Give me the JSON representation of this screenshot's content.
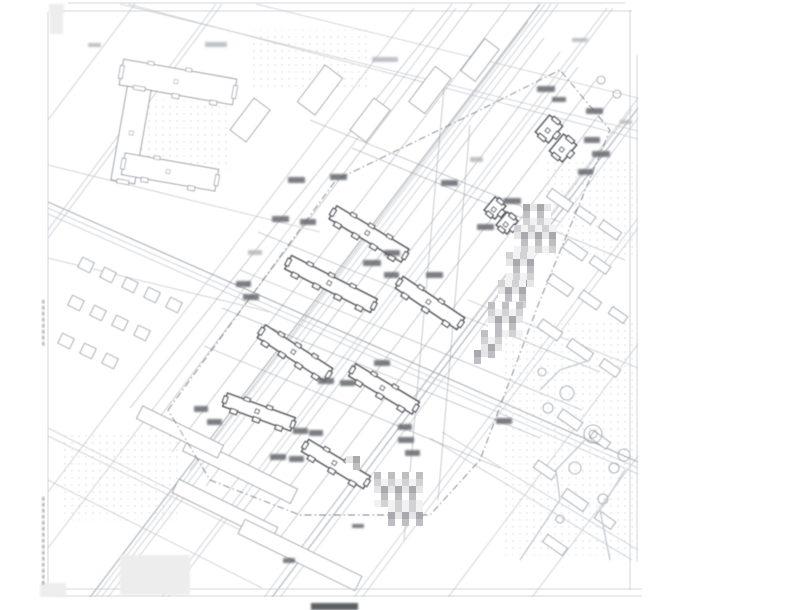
{
  "drawing": {
    "kind": "scanned architectural site plan (blurred, text illegible)",
    "canvas": {
      "w": 800,
      "h": 610,
      "bg": "#ffffff"
    },
    "clip": {
      "x": 46,
      "y": 3,
      "w": 596,
      "h": 594
    },
    "palette": {
      "frame": "#c7cacf",
      "line_light": "#c6cad0",
      "line_med": "#aab0b8",
      "line_dark": "#8d939b",
      "boundary": "#7d828a",
      "building_stroke": "#54585f",
      "building_fill": "#ffffff",
      "light_building_stroke": "#9aa0a8",
      "chip_dark": "#63666c",
      "chip_light": "#b7bbc1",
      "dot": "#aeb3bb",
      "mosaic_cells": [
        "#ffffff",
        "#e6e6e8",
        "#d2d2d5",
        "#bfbfc3",
        "#a8a8ad",
        "#f2f2f3"
      ]
    },
    "frame_lines": [
      [
        68,
        3,
        625,
        3,
        "light"
      ],
      [
        50,
        11,
        632,
        11,
        "light"
      ],
      [
        48,
        12,
        48,
        589,
        "light"
      ],
      [
        630,
        10,
        630,
        590,
        "light"
      ],
      [
        637,
        55,
        637,
        562,
        "light"
      ],
      [
        55,
        589,
        642,
        589,
        "light"
      ],
      [
        55,
        596,
        642,
        596,
        "light"
      ]
    ],
    "margin": {
      "title_chip": {
        "x": 311,
        "y": 603,
        "w": 47,
        "h": 7
      },
      "corner_chips": [
        {
          "x": 49,
          "y": 4,
          "w": 15,
          "h": 9
        },
        {
          "x": 50,
          "y": 10,
          "w": 13,
          "h": 24
        },
        {
          "x": 40,
          "y": 583,
          "w": 26,
          "h": 14
        },
        {
          "x": 120,
          "y": 555,
          "w": 70,
          "h": 40
        }
      ],
      "left_text_strips": [
        {
          "x": 42,
          "y": 300,
          "h": 44
        },
        {
          "x": 42,
          "y": 497,
          "h": 86
        }
      ]
    },
    "roads_b": [
      [
        88,
        600,
        540,
        4,
        "med"
      ],
      [
        93,
        600,
        545,
        4,
        "light"
      ],
      [
        99,
        600,
        551,
        4,
        "light"
      ],
      [
        106,
        600,
        558,
        4,
        "light"
      ],
      [
        48,
        548,
        456,
        8,
        "light"
      ],
      [
        48,
        492,
        414,
        8,
        "light"
      ],
      [
        160,
        600,
        607,
        8,
        "light"
      ],
      [
        166,
        600,
        613,
        8,
        "light"
      ],
      [
        262,
        600,
        638,
        98,
        "light"
      ],
      [
        270,
        600,
        638,
        108,
        "med"
      ],
      [
        278,
        600,
        638,
        118,
        "light"
      ],
      [
        352,
        600,
        638,
        218,
        "light"
      ],
      [
        360,
        600,
        638,
        228,
        "light"
      ],
      [
        446,
        600,
        638,
        344,
        "light"
      ],
      [
        48,
        238,
        222,
        4,
        "light"
      ],
      [
        48,
        230,
        216,
        4,
        "light"
      ],
      [
        48,
        120,
        135,
        4,
        "light"
      ],
      [
        530,
        600,
        638,
        456,
        "light"
      ]
    ],
    "roads_a": [
      [
        48,
        202,
        638,
        462,
        "med"
      ],
      [
        48,
        208,
        638,
        468,
        "light"
      ],
      [
        48,
        214,
        638,
        474,
        "light"
      ],
      [
        48,
        258,
        270,
        312,
        "light"
      ],
      [
        48,
        165,
        320,
        232,
        "light"
      ],
      [
        120,
        4,
        638,
        131,
        "light"
      ],
      [
        128,
        4,
        638,
        139,
        "light"
      ],
      [
        256,
        4,
        638,
        98,
        "light"
      ],
      [
        48,
        428,
        310,
        560,
        "light"
      ],
      [
        48,
        436,
        318,
        568,
        "light"
      ],
      [
        48,
        480,
        262,
        588,
        "light"
      ],
      [
        430,
        438,
        632,
        560,
        "light"
      ],
      [
        442,
        432,
        638,
        550,
        "light"
      ],
      [
        468,
        300,
        638,
        368,
        "light"
      ]
    ],
    "thin_lines": [
      [
        130,
        408,
        452,
        4
      ],
      [
        150,
        430,
        472,
        4
      ],
      [
        172,
        452,
        510,
        4
      ],
      [
        190,
        470,
        528,
        22
      ],
      [
        206,
        486,
        544,
        38
      ],
      [
        222,
        500,
        560,
        52
      ],
      [
        240,
        515,
        578,
        67
      ],
      [
        258,
        528,
        596,
        80
      ],
      [
        276,
        543,
        614,
        95
      ],
      [
        294,
        557,
        632,
        109
      ],
      [
        258,
        232,
        600,
        372
      ],
      [
        240,
        270,
        582,
        410
      ],
      [
        222,
        308,
        540,
        438
      ],
      [
        204,
        346,
        500,
        468
      ],
      [
        352,
        148,
        625,
        260
      ],
      [
        310,
        120,
        560,
        222
      ],
      [
        444,
        88,
        404,
        540
      ],
      [
        470,
        125,
        438,
        500
      ]
    ],
    "boundary": {
      "points": [
        [
          168,
          410
        ],
        [
          336,
          180
        ],
        [
          470,
          115
        ],
        [
          560,
          70
        ],
        [
          610,
          130
        ],
        [
          540,
          300
        ],
        [
          480,
          460
        ],
        [
          430,
          515
        ],
        [
          300,
          515
        ],
        [
          210,
          480
        ]
      ],
      "dash": "7 3 1.5 3"
    },
    "site_buildings": [
      {
        "cx": 369,
        "cy": 234,
        "len": 84,
        "wid": 15,
        "angle": 31,
        "teeth": 4
      },
      {
        "cx": 331,
        "cy": 284,
        "len": 96,
        "wid": 15,
        "angle": 27,
        "teeth": 4
      },
      {
        "cx": 430,
        "cy": 303,
        "len": 74,
        "wid": 14,
        "angle": 34,
        "teeth": 3
      },
      {
        "cx": 295,
        "cy": 353,
        "len": 80,
        "wid": 15,
        "angle": 33,
        "teeth": 4
      },
      {
        "cx": 384,
        "cy": 389,
        "len": 74,
        "wid": 14,
        "angle": 31,
        "teeth": 3
      },
      {
        "cx": 259,
        "cy": 412,
        "len": 72,
        "wid": 14,
        "angle": 20,
        "teeth": 3
      },
      {
        "cx": 336,
        "cy": 464,
        "len": 72,
        "wid": 14,
        "angle": 31,
        "teeth": 3
      },
      {
        "cx": 549,
        "cy": 129,
        "len": 22,
        "wid": 17,
        "angle": -50,
        "teeth": 1
      },
      {
        "cx": 563,
        "cy": 148,
        "len": 22,
        "wid": 17,
        "angle": -50,
        "teeth": 1
      },
      {
        "cx": 495,
        "cy": 208,
        "len": 17,
        "wid": 14,
        "angle": -50,
        "teeth": 1
      },
      {
        "cx": 507,
        "cy": 223,
        "len": 17,
        "wid": 14,
        "angle": -50,
        "teeth": 1
      }
    ],
    "u_block": [
      {
        "cx": 178,
        "cy": 82,
        "len": 115,
        "wid": 26,
        "angle": 10,
        "teeth": 3
      },
      {
        "cx": 131,
        "cy": 135,
        "len": 95,
        "wid": 24,
        "angle": 100,
        "teeth": 0
      },
      {
        "cx": 170,
        "cy": 172,
        "len": 95,
        "wid": 22,
        "angle": 10,
        "teeth": 2
      }
    ],
    "light_buildings": [
      {
        "cx": 560,
        "cy": 200,
        "w": 26,
        "h": 10,
        "angle": 35
      },
      {
        "cx": 585,
        "cy": 215,
        "w": 20,
        "h": 9,
        "angle": 35
      },
      {
        "cx": 610,
        "cy": 230,
        "w": 22,
        "h": 9,
        "angle": 35
      },
      {
        "cx": 575,
        "cy": 250,
        "w": 24,
        "h": 10,
        "angle": 35
      },
      {
        "cx": 600,
        "cy": 265,
        "w": 20,
        "h": 9,
        "angle": 35
      },
      {
        "cx": 560,
        "cy": 285,
        "w": 26,
        "h": 10,
        "angle": 35
      },
      {
        "cx": 590,
        "cy": 300,
        "w": 22,
        "h": 9,
        "angle": 35
      },
      {
        "cx": 618,
        "cy": 315,
        "w": 18,
        "h": 8,
        "angle": 35
      },
      {
        "cx": 550,
        "cy": 330,
        "w": 24,
        "h": 10,
        "angle": 35
      },
      {
        "cx": 580,
        "cy": 350,
        "w": 26,
        "h": 10,
        "angle": 35
      },
      {
        "cx": 610,
        "cy": 368,
        "w": 20,
        "h": 9,
        "angle": 35
      },
      {
        "cx": 570,
        "cy": 420,
        "w": 24,
        "h": 10,
        "angle": 35
      },
      {
        "cx": 600,
        "cy": 440,
        "w": 20,
        "h": 8,
        "angle": 35
      },
      {
        "cx": 545,
        "cy": 470,
        "w": 22,
        "h": 9,
        "angle": 35
      },
      {
        "cx": 575,
        "cy": 500,
        "w": 26,
        "h": 10,
        "angle": 35
      },
      {
        "cx": 605,
        "cy": 520,
        "w": 20,
        "h": 9,
        "angle": 35
      },
      {
        "cx": 555,
        "cy": 545,
        "w": 24,
        "h": 9,
        "angle": 35
      },
      {
        "cx": 320,
        "cy": 90,
        "w": 46,
        "h": 22,
        "angle": -53
      },
      {
        "cx": 370,
        "cy": 120,
        "w": 40,
        "h": 20,
        "angle": -53
      },
      {
        "cx": 430,
        "cy": 90,
        "w": 44,
        "h": 20,
        "angle": -53
      },
      {
        "cx": 480,
        "cy": 60,
        "w": 40,
        "h": 18,
        "angle": -53
      },
      {
        "cx": 250,
        "cy": 120,
        "w": 40,
        "h": 20,
        "angle": -53
      },
      {
        "cx": 240,
        "cy": 470,
        "w": 120,
        "h": 16,
        "angle": 26
      },
      {
        "cx": 225,
        "cy": 510,
        "w": 110,
        "h": 15,
        "angle": 26
      },
      {
        "cx": 300,
        "cy": 555,
        "w": 130,
        "h": 16,
        "angle": 26
      },
      {
        "cx": 180,
        "cy": 432,
        "w": 90,
        "h": 14,
        "angle": 26
      },
      {
        "cx": 86,
        "cy": 265,
        "w": 13,
        "h": 11,
        "angle": 26
      },
      {
        "cx": 108,
        "cy": 275,
        "w": 13,
        "h": 11,
        "angle": 26
      },
      {
        "cx": 130,
        "cy": 285,
        "w": 13,
        "h": 11,
        "angle": 26
      },
      {
        "cx": 152,
        "cy": 295,
        "w": 13,
        "h": 11,
        "angle": 26
      },
      {
        "cx": 174,
        "cy": 305,
        "w": 13,
        "h": 11,
        "angle": 26
      },
      {
        "cx": 76,
        "cy": 303,
        "w": 13,
        "h": 11,
        "angle": 26
      },
      {
        "cx": 98,
        "cy": 313,
        "w": 13,
        "h": 11,
        "angle": 26
      },
      {
        "cx": 120,
        "cy": 323,
        "w": 13,
        "h": 11,
        "angle": 26
      },
      {
        "cx": 142,
        "cy": 333,
        "w": 13,
        "h": 11,
        "angle": 26
      },
      {
        "cx": 66,
        "cy": 341,
        "w": 13,
        "h": 11,
        "angle": 26
      },
      {
        "cx": 88,
        "cy": 351,
        "w": 13,
        "h": 11,
        "angle": 26
      },
      {
        "cx": 110,
        "cy": 361,
        "w": 13,
        "h": 11,
        "angle": 26
      }
    ],
    "chips_dark": [
      [
        288,
        177,
        17,
        6
      ],
      [
        330,
        174,
        17,
        6
      ],
      [
        272,
        216,
        17,
        6
      ],
      [
        300,
        219,
        16,
        6
      ],
      [
        363,
        260,
        18,
        6
      ],
      [
        426,
        272,
        17,
        6
      ],
      [
        477,
        224,
        17,
        6
      ],
      [
        504,
        198,
        17,
        6
      ],
      [
        537,
        86,
        18,
        6
      ],
      [
        552,
        97,
        14,
        5
      ],
      [
        586,
        108,
        17,
        6
      ],
      [
        584,
        137,
        16,
        6
      ],
      [
        592,
        151,
        18,
        6
      ],
      [
        578,
        169,
        15,
        6
      ],
      [
        441,
        180,
        17,
        6
      ],
      [
        384,
        250,
        16,
        6
      ],
      [
        384,
        272,
        15,
        6
      ],
      [
        236,
        281,
        15,
        6
      ],
      [
        243,
        294,
        16,
        6
      ],
      [
        374,
        360,
        16,
        6
      ],
      [
        318,
        378,
        16,
        6
      ],
      [
        340,
        380,
        15,
        6
      ],
      [
        293,
        428,
        15,
        6
      ],
      [
        309,
        430,
        14,
        6
      ],
      [
        194,
        406,
        14,
        6
      ],
      [
        207,
        419,
        15,
        6
      ],
      [
        270,
        454,
        16,
        6
      ],
      [
        289,
        456,
        15,
        6
      ],
      [
        398,
        424,
        14,
        6
      ],
      [
        398,
        437,
        16,
        6
      ],
      [
        405,
        450,
        15,
        6
      ],
      [
        496,
        418,
        16,
        6
      ],
      [
        283,
        558,
        12,
        5
      ],
      [
        352,
        524,
        12,
        4
      ]
    ],
    "chips_light": [
      [
        372,
        57,
        26,
        5
      ],
      [
        205,
        42,
        22,
        5
      ],
      [
        88,
        43,
        13,
        4
      ],
      [
        572,
        38,
        16,
        4
      ],
      [
        620,
        120,
        12,
        4
      ],
      [
        470,
        157,
        13,
        5
      ],
      [
        248,
        250,
        14,
        5
      ]
    ],
    "mosaic": {
      "cell": 7,
      "blocks": [
        [
          523,
          204,
          28,
          22
        ],
        [
          514,
          225,
          36,
          28
        ],
        [
          506,
          252,
          28,
          29
        ],
        [
          498,
          280,
          22,
          24
        ],
        [
          488,
          302,
          29,
          29
        ],
        [
          481,
          330,
          21,
          22
        ],
        [
          474,
          350,
          14,
          8
        ],
        [
          374,
          472,
          49,
          35
        ],
        [
          388,
          505,
          35,
          18
        ],
        [
          346,
          456,
          14,
          12
        ]
      ]
    },
    "circles": [
      [
        567,
        393,
        7
      ],
      [
        548,
        408,
        5
      ],
      [
        593,
        434,
        9
      ],
      [
        593,
        434,
        4
      ],
      [
        575,
        468,
        6
      ],
      [
        614,
        468,
        5
      ],
      [
        603,
        499,
        5
      ],
      [
        560,
        519,
        4
      ],
      [
        601,
        80,
        4
      ],
      [
        617,
        94,
        4
      ],
      [
        542,
        372,
        4
      ],
      [
        624,
        455,
        6
      ]
    ],
    "garden_paths": [
      [
        [
          520,
          560
        ],
        [
          560,
          500
        ],
        [
          556,
          470
        ],
        [
          585,
          440
        ]
      ],
      [
        [
          610,
          560
        ],
        [
          600,
          510
        ],
        [
          625,
          470
        ]
      ],
      [
        [
          540,
          390
        ],
        [
          560,
          370
        ],
        [
          590,
          360
        ]
      ]
    ],
    "dots_regions": [
      {
        "x": 505,
        "y": 320,
        "w": 130,
        "h": 235
      },
      {
        "x": 138,
        "y": 100,
        "w": 92,
        "h": 70
      },
      {
        "x": 545,
        "y": 160,
        "w": 90,
        "h": 100
      },
      {
        "x": 60,
        "y": 430,
        "w": 120,
        "h": 90
      },
      {
        "x": 250,
        "y": 30,
        "w": 120,
        "h": 60
      }
    ]
  }
}
